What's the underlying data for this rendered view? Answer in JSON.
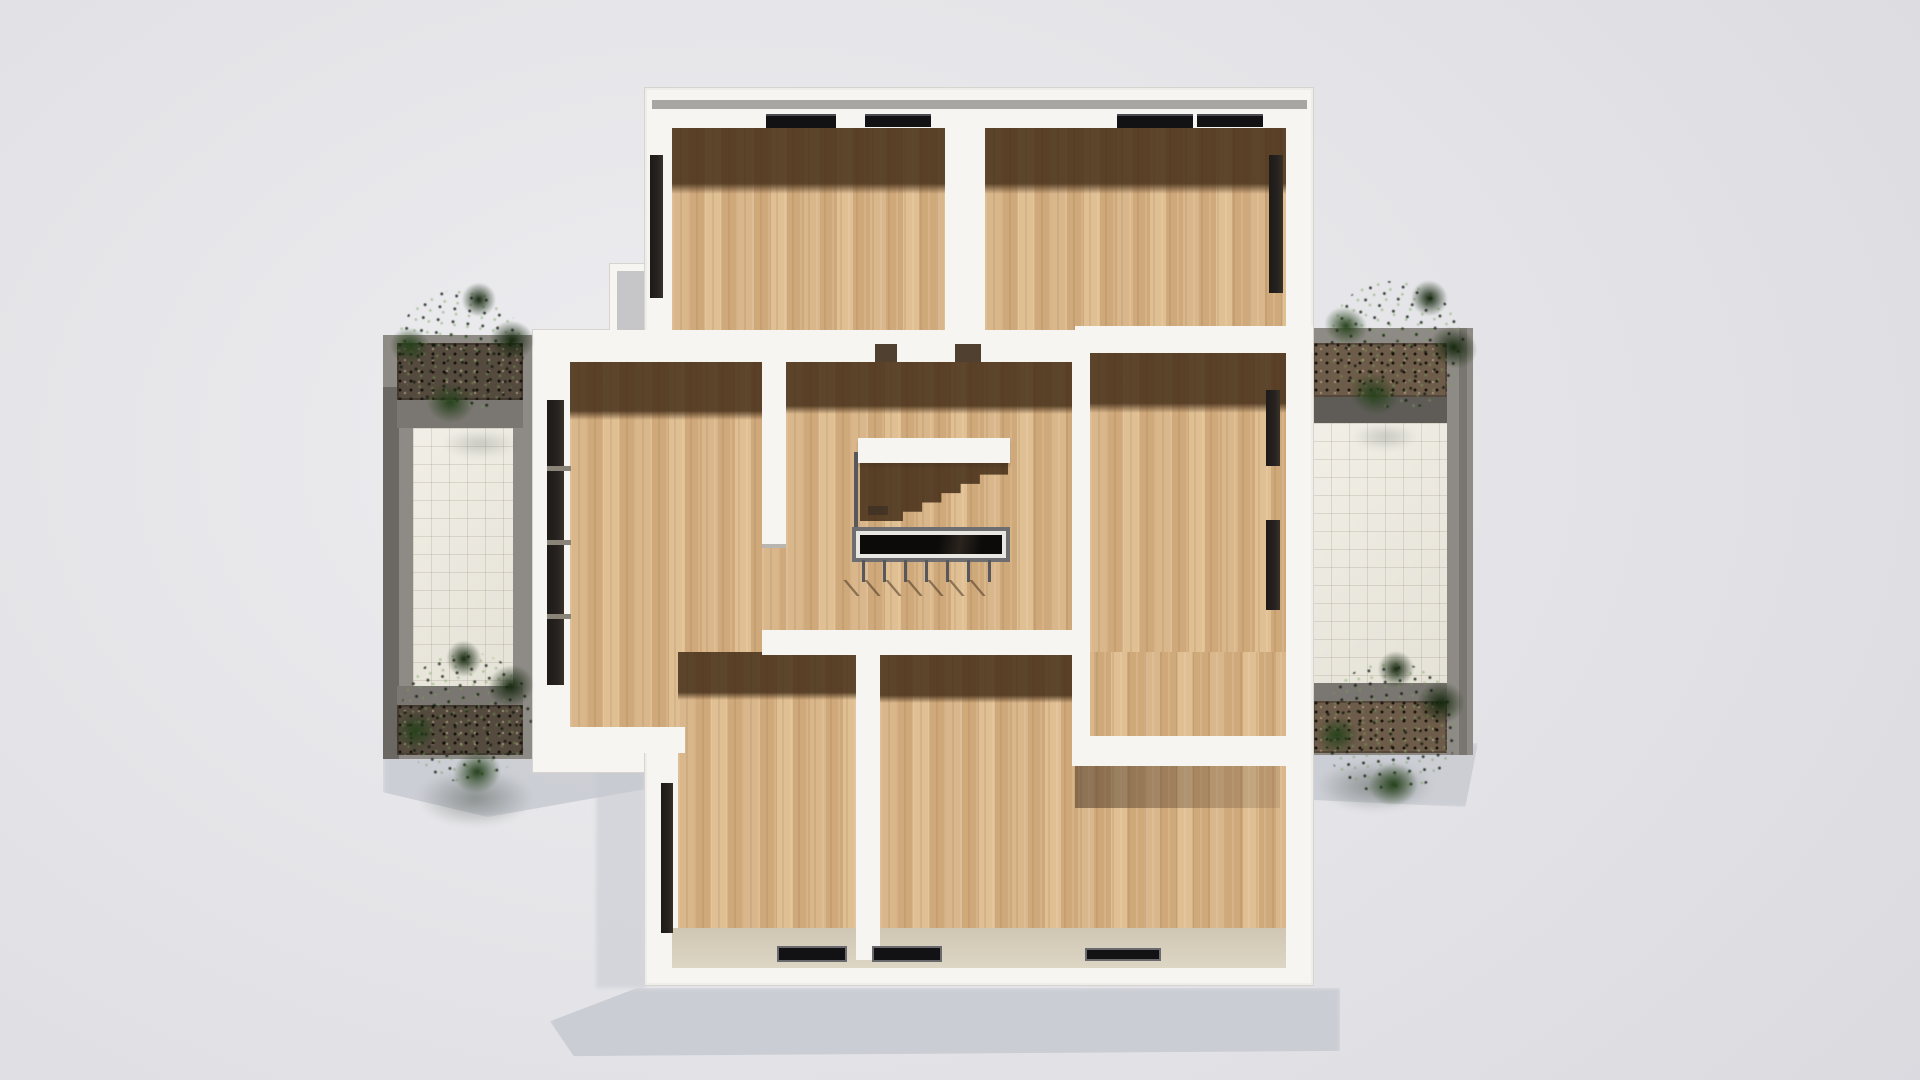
{
  "scene": {
    "kind": "3d-architectural-render",
    "view": "top-down orthographic floor plan, upper storey, no furniture",
    "background": "plain light-gray studio backdrop with soft building shadow cast to the lower left"
  },
  "palette": {
    "bg1": "#eeeef1",
    "bg2": "#e3e3e7",
    "bg3": "#d9d9de",
    "shadow": "#c6c9d0",
    "wall": "#f6f5f2",
    "wall-edge": "#d7d4cf",
    "coping": "#a8a6a2",
    "wood1": "#dab78b",
    "wood2": "#d0a97b",
    "wood3": "#e0bf93",
    "room-shadow": "rgba(56,35,15,0.78)",
    "face": "#ded6c4",
    "tgray": "#8e8a85",
    "tgray-dark": "#6b6762",
    "tband": "#7a7671",
    "tband-dark": "#5f5c58",
    "tile": "#ece9de",
    "tile-line": "rgba(120,110,90,0.18)",
    "soil-l": "#554a3e",
    "soil-r": "#6e5c4a",
    "p1": "#16280f",
    "p2": "#27421c",
    "p3": "#3a5c28",
    "black": "#121214",
    "door": "#262220",
    "rail": "#58585c",
    "frame": "#6e6e71",
    "rim": "#e9e7e2",
    "hole": "#0c0b0a",
    "step-shadow": "rgba(58,36,16,0.8)",
    "stub-shadow": "rgba(60,42,26,0.5)"
  },
  "building": {
    "floor_material": "light oak parquet planks",
    "wall_color": "white",
    "rooms": [
      {
        "name": "top-left-room",
        "features": [
          "two ceiling/window bars on north wall",
          "dark door on west wall"
        ]
      },
      {
        "name": "top-right-room",
        "features": [
          "two window bars on north wall",
          "dark door on east wall"
        ]
      },
      {
        "name": "middle-left-room",
        "features": [
          "tall glazed door on west wall toward left terrace"
        ]
      },
      {
        "name": "stair-hall",
        "features": [
          "open stairwell with black opening",
          "metal railing with balusters",
          "stepped stair shadow"
        ]
      },
      {
        "name": "middle-right-room",
        "features": [
          "two dark openings on east wall toward right terrace"
        ]
      },
      {
        "name": "bottom-left-room",
        "features": [
          "dark door on west wall",
          "window bar on south wall"
        ]
      },
      {
        "name": "bottom-right-room",
        "features": [
          "two window bars on south wall",
          "interior wall stub casting shadow"
        ]
      }
    ],
    "stair": {
      "opening": "black rectangular stairwell",
      "railing": "thin gray rail with 7 balusters",
      "steps_visible": true
    }
  },
  "terraces": [
    {
      "side": "left",
      "floor": "cream square tiles",
      "parapet": "gray concrete",
      "planters": 2,
      "plants": 2
    },
    {
      "side": "right",
      "floor": "cream square tiles",
      "parapet": "gray concrete",
      "planters": 2,
      "plants": 2
    }
  ],
  "vegetation": {
    "plant_count": 4,
    "type": "dark green shrubs in parapet planters"
  },
  "lighting": "sun from the south-east; interior north walls cast deep brown shadow bands on the wood floors"
}
